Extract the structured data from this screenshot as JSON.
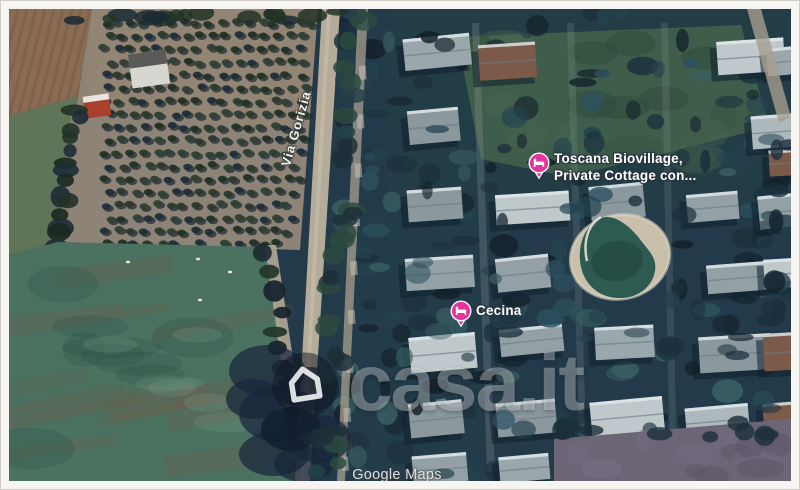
{
  "map": {
    "road_label": "Via Gorizia",
    "pins": [
      {
        "name": "Toscana Biovillage",
        "label_line1": "Toscana Biovillage,",
        "label_line2": "Private Cottage con...",
        "category": "lodging",
        "pin_color": "#e6339b",
        "icon": "bed-icon"
      },
      {
        "name": "Cecina",
        "label": "Cecina",
        "category": "lodging",
        "pin_color": "#e6339b",
        "icon": "bed-icon"
      }
    ],
    "attribution": "Google Maps"
  },
  "watermark": {
    "brand": "casa.it",
    "icon": "house-icon"
  },
  "colors": {
    "pin_pink": "#e6339b",
    "village_base": "#223a49",
    "field_green": "#4b7260",
    "road_tan": "#b5ab99",
    "pond_water": "#2d5a51",
    "frame_border": "#f7f5f2"
  }
}
